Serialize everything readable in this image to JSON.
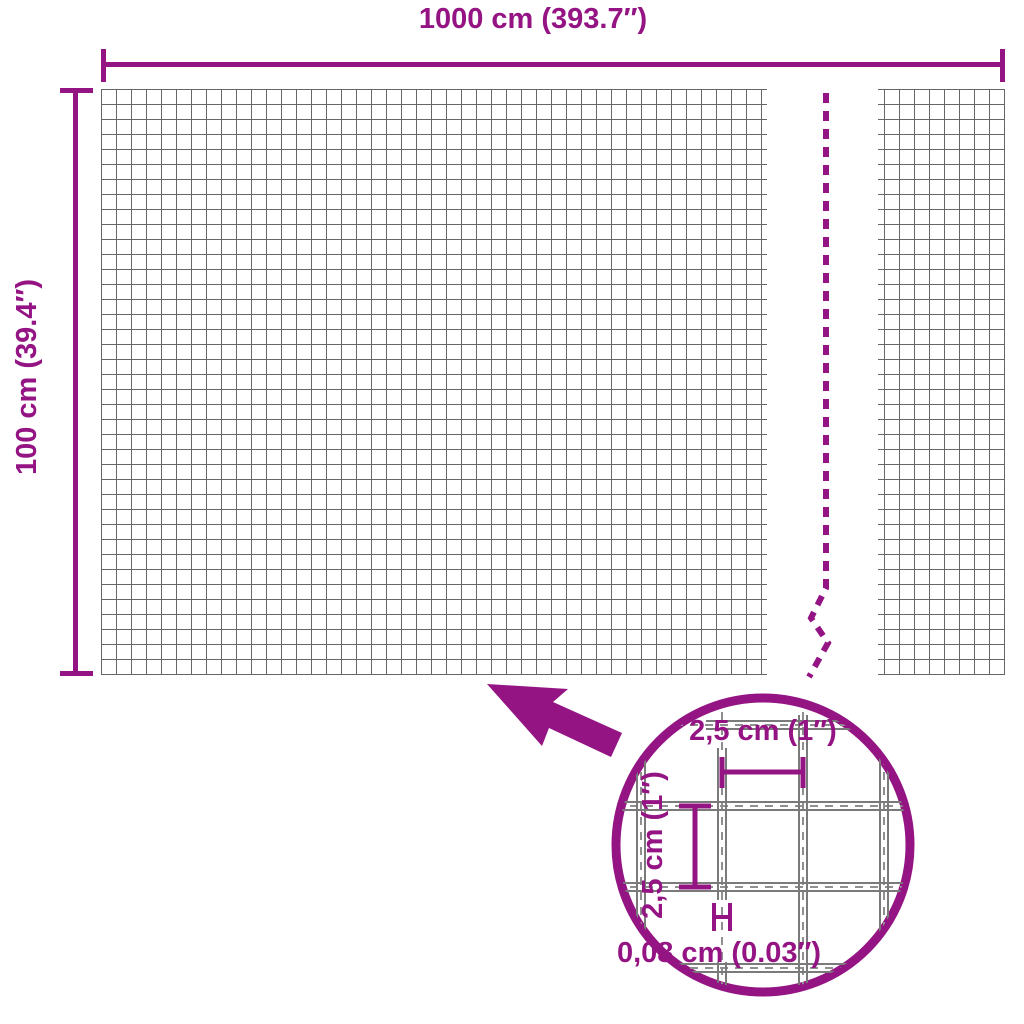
{
  "colors": {
    "accent": "#941484",
    "grid_line": "#666666",
    "wire_gray": "#7a7a7a",
    "dash_gray": "#8f8f8f",
    "background": "#ffffff"
  },
  "diagram": {
    "width_dimension": "1000 cm (393.7″)",
    "height_dimension": "100 cm (39.4″)"
  },
  "magnifier": {
    "mesh_width": "2,5 cm (1″)",
    "mesh_height": "2,5 cm (1″)",
    "wire_thickness": "0,08 cm (0.03″)"
  }
}
